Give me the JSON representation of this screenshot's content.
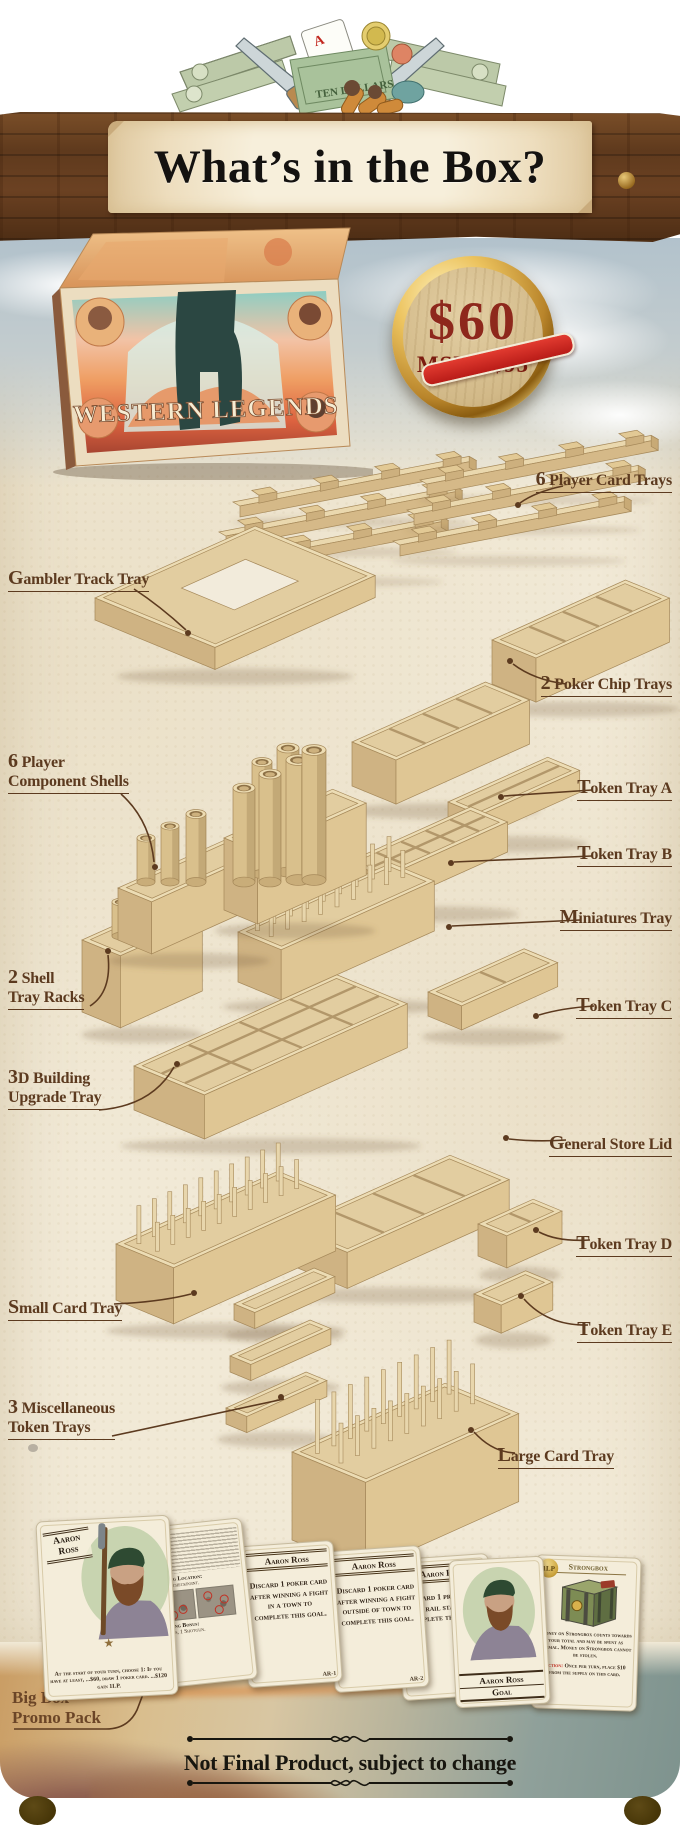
{
  "banner": {
    "title": "What’s in the Box?"
  },
  "price_badge": {
    "old_price": "$60",
    "msrp": "MSRP $95"
  },
  "product_box": {
    "title": "WESTERN LEGENDS"
  },
  "annotations": [
    {
      "label": "6 Player Card Trays"
    },
    {
      "label": "Gambler Track Tray"
    },
    {
      "label": "2 Poker Chip Trays"
    },
    {
      "label": "6 Player\nComponent Shells"
    },
    {
      "label": "Token Tray A"
    },
    {
      "label": "Token Tray B"
    },
    {
      "label": "Miniatures Tray"
    },
    {
      "label": "2 Shell\nTray Racks"
    },
    {
      "label": "Token Tray C"
    },
    {
      "label": "3D Building\nUpgrade Tray"
    },
    {
      "label": "General Store Lid"
    },
    {
      "label": "Token Tray D"
    },
    {
      "label": "Small Card Tray"
    },
    {
      "label": "Token Tray E"
    },
    {
      "label": "3 Miscellaneous\nToken Trays"
    },
    {
      "label": "Large Card Tray"
    }
  ],
  "promo": {
    "label": "Big Box\nPromo Pack"
  },
  "cards": {
    "character": {
      "first_name": "Aaron",
      "last_name": "Ross",
      "ability": "At the start of your turn, choose 1: If you have at least, ...$60, draw 1 poker card. ...$120 gain 1LP."
    },
    "bio": {
      "location_label": "Starting Location:",
      "location_value": "...train checkpoint.",
      "bonus_label": "Starting Bonus:",
      "bonus_value": "...cards, 1 Shotgun."
    },
    "goal_1": {
      "title": "Aaron Ross",
      "text": "Discard 1 poker card after winning a fight in a town to complete this goal.",
      "code": "AR-1"
    },
    "goal_2": {
      "title": "Aaron Ross",
      "text": "Discard 1 poker card after winning a fight outside of town to complete this goal.",
      "code": "AR-2"
    },
    "goal_3": {
      "title": "Aaron Ross",
      "text": "Discard 1 provisions at a rail station to complete this goal.",
      "code": "AR-3"
    },
    "goal_summary": {
      "title": "Aaron Ross",
      "subtitle": "Goal"
    },
    "strongbox": {
      "badge": "1LP",
      "title": "Strongbox",
      "body": "Money on Strongbox counts towards your total and may be spent as normal. Money on Strongbox cannot be stolen.",
      "action_label": "Action:",
      "action_text": "Once per turn, place $10 from the supply on this card."
    }
  },
  "footer": {
    "disclaimer": "Not Final Product, subject to change"
  }
}
